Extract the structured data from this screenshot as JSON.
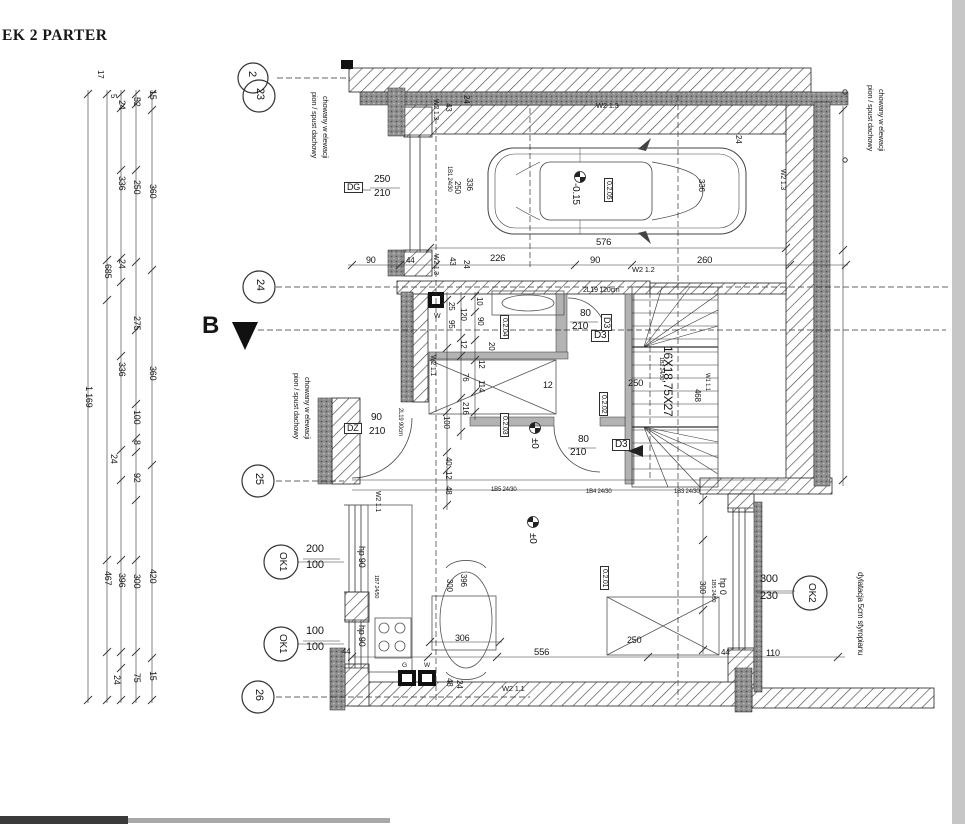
{
  "texts": {
    "title": "EK 2 PARTER",
    "sectionB": "B",
    "g2": "2",
    "g23": "23",
    "g24": "24",
    "g25": "25",
    "g26": "26",
    "pion1": "pion / spust dachowy",
    "pion2": "chowany w elewacji",
    "dylatacja": "dylatacja 5cm styropianu",
    "dg": "DG",
    "dz": "DZ",
    "d3": "D3",
    "ok1": "OK1",
    "ok2": "OK2",
    "hp90": "hp 90",
    "hp0": "hp 0",
    "w11": "W1 1.1",
    "w211": "W2 1.1",
    "w212": "W2 1.2",
    "w213": "W2 1.3",
    "r01": "0.2.01",
    "r02": "0.2.02",
    "r03": "0.2.03",
    "r04": "0.2.04",
    "r05": "0.2.05",
    "stairsNote": "16X18,75X27",
    "b1": "1B1 24/30",
    "b2": "1B2 24/30",
    "b3": "1B3 24/30",
    "b4": "1B4 24/30",
    "b5": "1B5 24/30",
    "b5b": "1B5 24/50",
    "b7": "1B7 24/50",
    "l120": "2L19 120cm",
    "l90": "2L19 90cm",
    "lev015": "-0.15",
    "lev0": "±0",
    "gMeter": "G",
    "wMeter": "W",
    "total": "1 169",
    "n5": "5",
    "n8": "8",
    "n10": "10",
    "n12": "12",
    "n15": "15",
    "n17": "17",
    "n20": "20",
    "n24": "24",
    "n25": "25",
    "n40": "40",
    "n43": "43",
    "n44": "44",
    "n48": "48",
    "n52": "52",
    "n75": "75",
    "n76": "76",
    "n80": "80",
    "n90": "90",
    "n92": "92",
    "n95": "95",
    "n100": "100",
    "n110": "110",
    "n114": "114",
    "n120": "120",
    "n200": "200",
    "n210": "210",
    "n216": "216",
    "n226": "226",
    "n230": "230",
    "n250": "250",
    "n260": "260",
    "n275": "275",
    "n300": "300",
    "n306": "306",
    "n336": "336",
    "n360": "360",
    "n396": "396",
    "n420": "420",
    "n467": "467",
    "n468": "468",
    "n556": "556",
    "n576": "576",
    "n685": "685"
  },
  "summary": {
    "grid_axes": [
      "2",
      "23",
      "24",
      "25",
      "26"
    ],
    "rooms": [
      "0.2.01",
      "0.2.02",
      "0.2.03",
      "0.2.04",
      "0.2.05"
    ],
    "doors": [
      {
        "symbol": "DG",
        "dims": "250/210"
      },
      {
        "symbol": "DZ",
        "dims": "90/210"
      },
      {
        "symbol": "D3",
        "dims": "80/210"
      }
    ],
    "windows": [
      {
        "symbol": "OK1",
        "dims": "200/100",
        "parapet": "hp 90"
      },
      {
        "symbol": "OK1",
        "dims": "100/100",
        "parapet": "hp 90"
      },
      {
        "symbol": "OK2",
        "dims": "300/230",
        "parapet": "hp 0"
      }
    ],
    "stair_note": "16X18,75X27",
    "wall_types": [
      "W1 1.1",
      "W2 1.1",
      "W2 1.2",
      "W2 1.3"
    ],
    "beams": [
      "1B1 24/30",
      "1B2 24/30",
      "1B3 24/30",
      "1B4 24/30",
      "1B5 24/30",
      "1B5 24/50",
      "1B7 24/50"
    ],
    "lintels": [
      "2L19 120cm",
      "2L19 90cm"
    ],
    "levels": [
      "-0.15",
      "±0"
    ],
    "notes": [
      "pion / spust dachowy chowany w elewacji",
      "dylatacja 5cm styropianu"
    ],
    "section_marker": "B",
    "overall_height_dim": "1 169"
  }
}
